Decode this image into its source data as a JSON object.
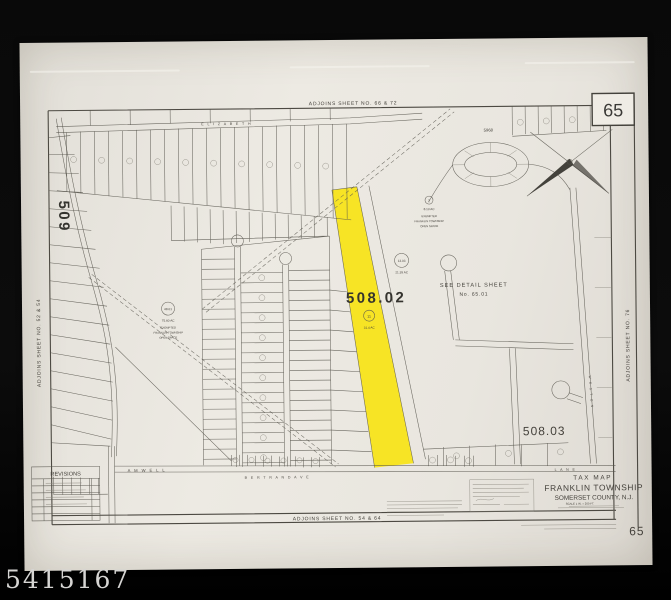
{
  "photo": {
    "watermark": "5415167"
  },
  "map": {
    "sheet_number": "65",
    "footer_sheet_number": "65",
    "adjoins_top": "ADJOINS SHEET NO. 66 & 72",
    "adjoins_bottom": "ADJOINS SHEET NO. 54 & 64",
    "adjoins_left": "ADJOINS SHEET NO. 52 & 54",
    "adjoins_right": "ADJOINS SHEET NO. 76",
    "block_509": "509",
    "block_508_02": "508.02",
    "block_508_03": "508.03",
    "detail_note_line1": "SEE DETAIL SHEET",
    "detail_note_line2": "No. 65.01",
    "tract_5968": "5968",
    "lots": {
      "lot2_number": "2",
      "lot2_area": "8.13 AC",
      "lot2_note1": "EXEMPTED",
      "lot2_note2": "FRANKLIN TOWNSHIP",
      "lot2_note3": "OPEN SPACE",
      "lot13_number": "13.03",
      "lot13_area": "21.39 AC",
      "lot11_number": "11",
      "lot11_area": "31.4 AC",
      "lot48_number": "48.01",
      "lot48_area": "75.60 AC",
      "lot48_note1": "EXEMPTED",
      "lot48_note2": "FRANKLIN TOWNSHIP",
      "lot48_note3": "OPEN SPACE"
    },
    "roads": {
      "elizabeth": "E L I Z A B E T H",
      "amwell": "A M W E L L",
      "bertrand": "B E R T R A N D   A V E",
      "lane": "L A N E",
      "weston": "W E S T O N"
    },
    "revisions_title": "REVISIONS",
    "title_block": {
      "line1": "TAX MAP",
      "line2": "FRANKLIN TOWNSHIP",
      "line3": "SOMERSET COUNTY, N.J.",
      "line4": "SCALE 1 IN. = 200 FT."
    }
  },
  "colors": {
    "highlight": "#f8e41a",
    "paper": "#e9e6df",
    "ink": "#57544c",
    "frame": "#000000"
  }
}
